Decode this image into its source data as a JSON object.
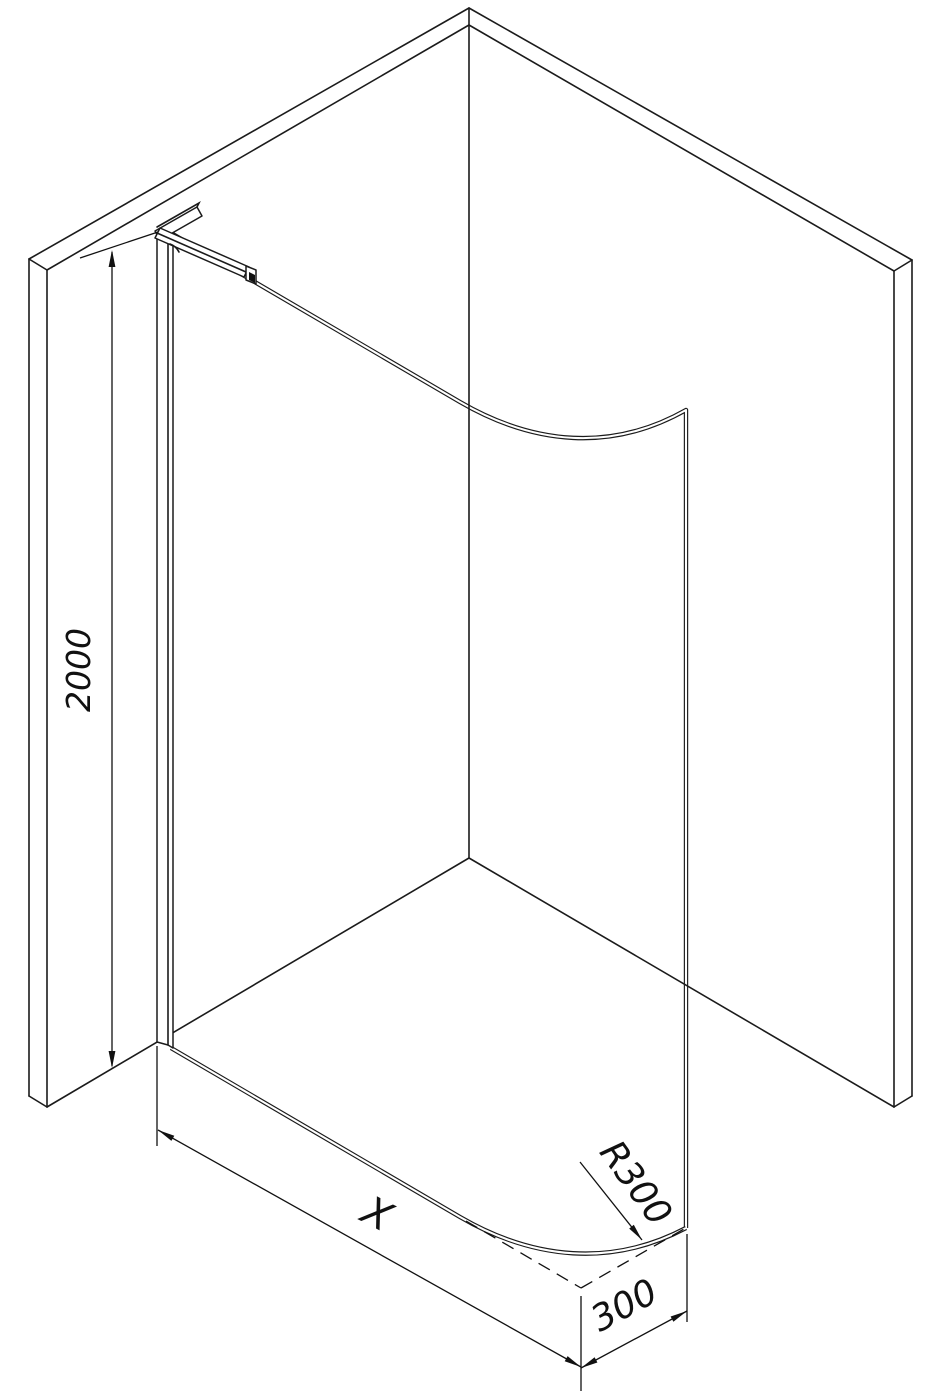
{
  "drawing": {
    "title": "walk-in-shower-glass-panel-technical-drawing",
    "background_color": "#ffffff",
    "line_color": "#1b1b1b",
    "dimensions": {
      "height": {
        "label": "2000"
      },
      "width": {
        "label": "X"
      },
      "curve_depth": {
        "label": "300"
      },
      "corner_radius": {
        "label": "R300"
      }
    }
  }
}
